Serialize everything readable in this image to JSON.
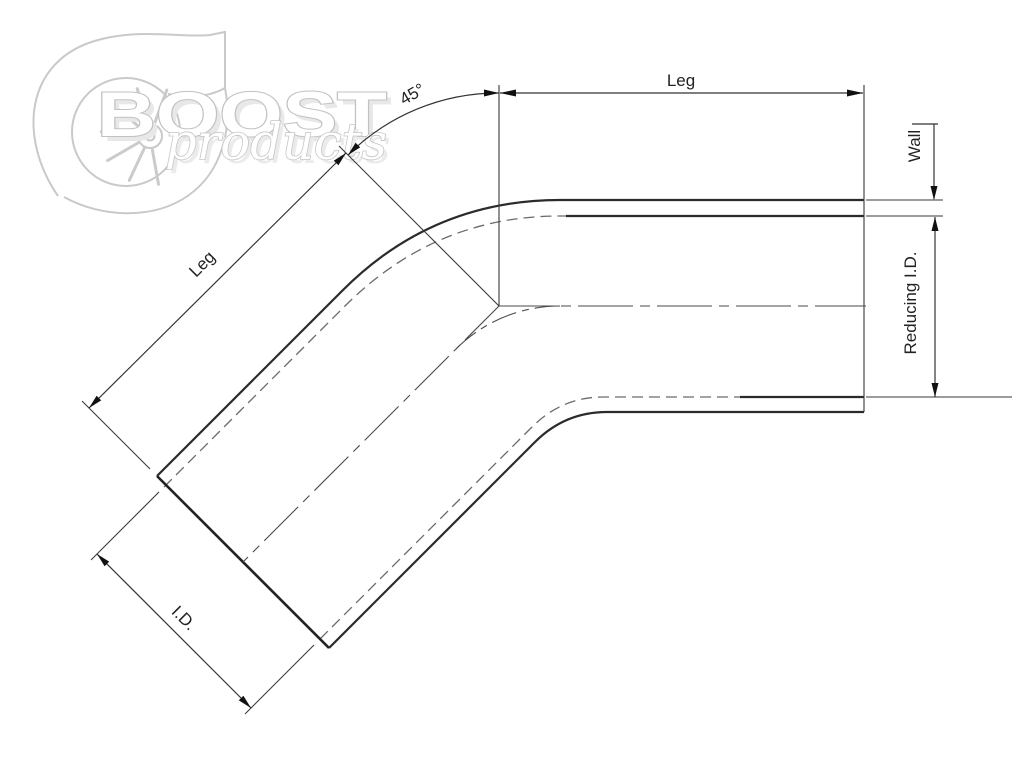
{
  "watermark": {
    "brand_primary": "BOOST",
    "brand_secondary": "products"
  },
  "dimensions": {
    "top_leg_label": "Leg",
    "diagonal_leg_label": "Leg",
    "angle_label": "45°",
    "wall_label": "Wall",
    "reducing_id_label": "Reducing I.D.",
    "id_label": "I.D."
  },
  "colors": {
    "background": "#ffffff",
    "drawing_line": "#2b2b2b",
    "dimension_line": "#333333",
    "hidden_line": "#6a6a6a",
    "watermark": "#c9c9c9"
  }
}
